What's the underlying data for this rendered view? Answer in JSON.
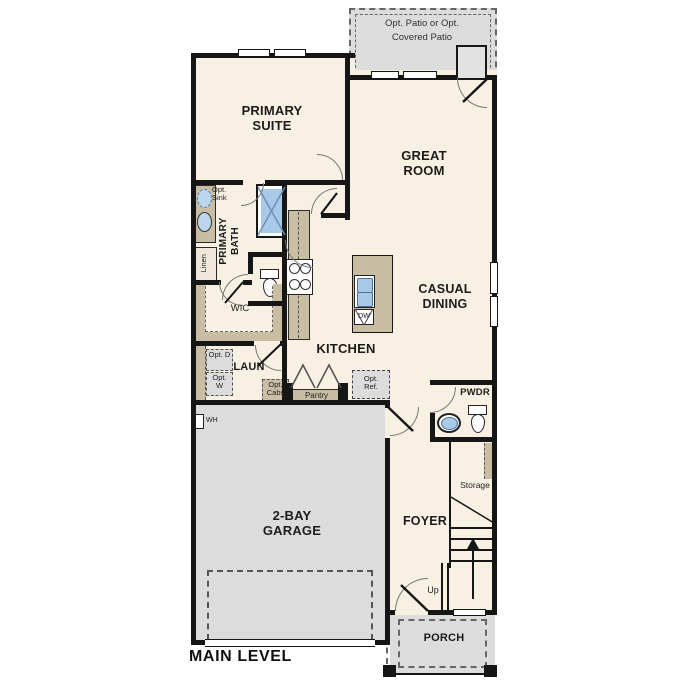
{
  "title": "MAIN LEVEL",
  "rooms": {
    "primary_suite": "PRIMARY SUITE",
    "great_room": "GREAT ROOM",
    "casual_dining": "CASUAL DINING",
    "kitchen": "KITCHEN",
    "primary_bath": "PRIMARY BATH",
    "wic": "WIC",
    "laundry": "LAUN",
    "powder": "PWDR",
    "foyer": "FOYER",
    "garage": "2-BAY GARAGE",
    "porch": "PORCH",
    "storage": "Storage",
    "pantry": "Pantry",
    "linen": "Linen"
  },
  "annotations": {
    "opt_patio": "Opt. Patio or Opt. Covered Patio",
    "opt_sink": "Opt. Sink",
    "opt_dryer": "Opt. D",
    "opt_washer": "Opt. W",
    "opt_cabs": "Opt. Cabs",
    "opt_ref": "Opt. Ref.",
    "dishwasher": "DW",
    "water_heater": "WH",
    "up": "Up"
  },
  "colors": {
    "wall": "#161616",
    "room_fill": "#f8f1e3",
    "exterior_fill": "#dcdcdc",
    "cabinet_fill": "#c9bda4",
    "fixture_blue": "#aac9e8",
    "background": "#ffffff"
  }
}
